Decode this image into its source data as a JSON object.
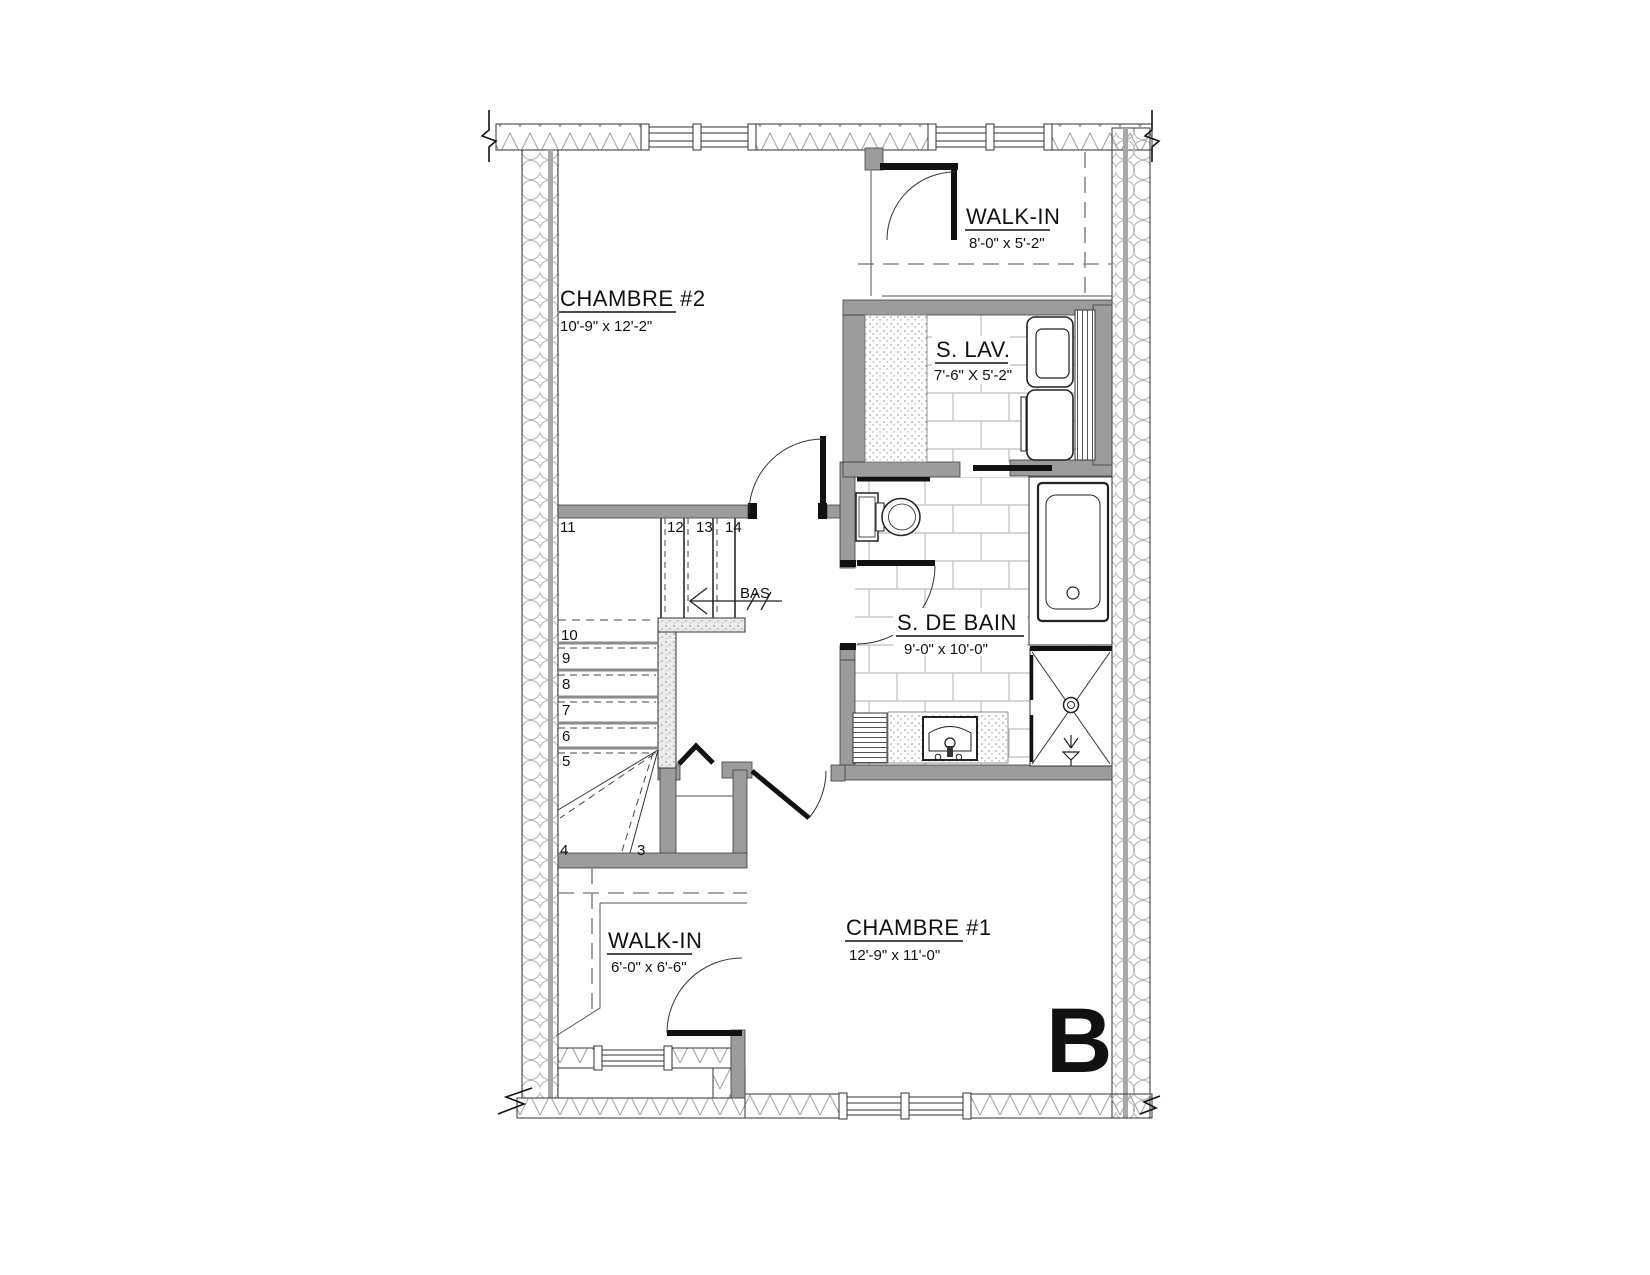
{
  "floor_plan": {
    "unit_letter": "B",
    "rooms": [
      {
        "name": "CHAMBRE #2",
        "dims": "10'-9\" x 12'-2\""
      },
      {
        "name": "WALK-IN",
        "dims": "8'-0\" x 5'-2\""
      },
      {
        "name": "S. LAV.",
        "dims": "7'-6\" X 5'-2\""
      },
      {
        "name": "S. DE BAIN",
        "dims": "9'-0\" x 10'-0\""
      },
      {
        "name": "WALK-IN",
        "dims": "6'-0\" x 6'-6\""
      },
      {
        "name": "CHAMBRE #1",
        "dims": "12'-9\" x 11'-0\""
      }
    ],
    "stairs": {
      "direction_label": "BAS",
      "steps": {
        "s3": "3",
        "s4": "4",
        "s5": "5",
        "s6": "6",
        "s7": "7",
        "s8": "8",
        "s9": "9",
        "s10": "10",
        "s11": "11",
        "s12": "12",
        "s13": "13",
        "s14": "14"
      }
    },
    "colors": {
      "wall_fill": "#9c9c9c",
      "line": "#1a1a1a",
      "tile_line": "#bdbdbd",
      "insulation_line": "#a8a8a8"
    }
  }
}
